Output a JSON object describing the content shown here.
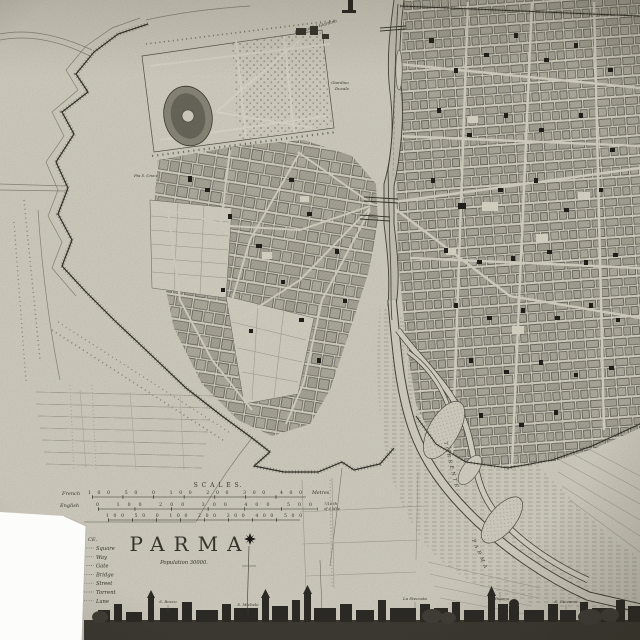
{
  "colors": {
    "paper": "#d6d2c5",
    "ink": "#35332b",
    "block_fill": "#b5b1a4",
    "landmark_black": "#22211c",
    "skyline_dark": "#2f2d27",
    "photo_background": "#fcfcfa"
  },
  "title_block": {
    "title": "PARMA",
    "population": "Population 30000."
  },
  "scales": {
    "heading": "S C A L E S.",
    "french_label": "French",
    "french_ticks": "100 50 0 100 200 300 400",
    "french_unit": "Metres",
    "english_label": "English",
    "english_ticks": "0 100 200 300 400 500",
    "english_fraction_top": "7/10 th",
    "english_fraction_bottom": "of a Mile",
    "third_ticks": "100 50 0 100 200 300 400 500"
  },
  "legend": {
    "heading_fragment": "CE.",
    "items": [
      "Square",
      "Way",
      "Gate",
      "Bridge",
      "Street",
      "Torrent",
      "Lane"
    ]
  },
  "map_labels": {
    "palace": "Palazzo del Giardino",
    "garden_line1": "Giardino",
    "garden_line2": "Ducale",
    "gate_west": "Pta S. Croce",
    "river_upper": "TORRENTE",
    "river_lower": "PARMA"
  },
  "skyline": {
    "labels": [
      "S. Rocco",
      "S. Michele",
      "La Steccata",
      "Il Duomo",
      "S. Giovanni"
    ]
  }
}
